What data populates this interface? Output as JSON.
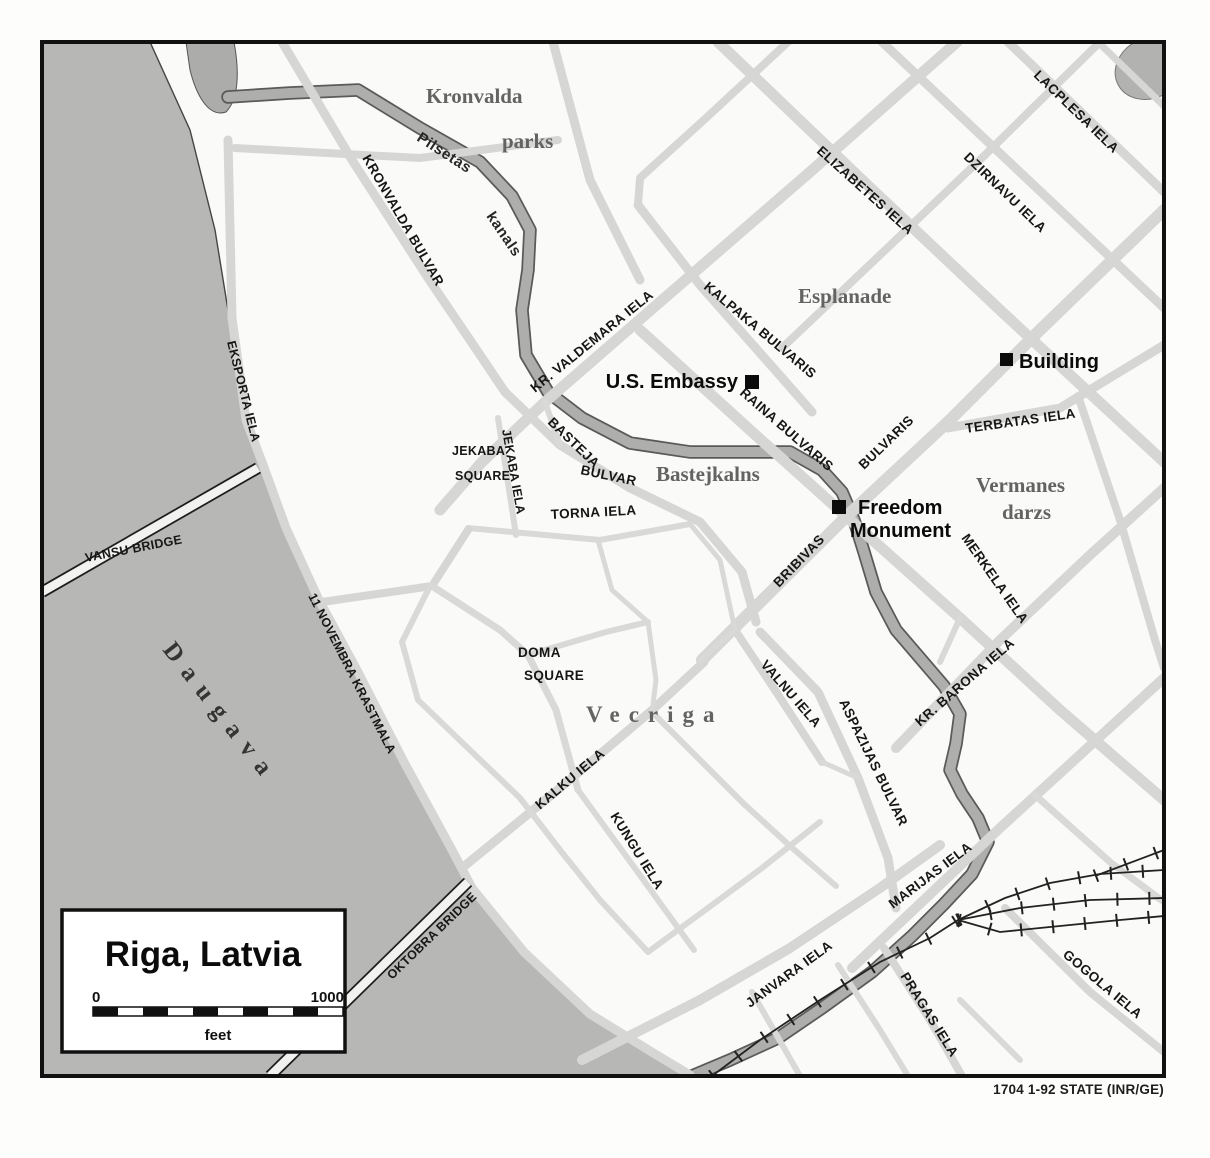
{
  "map": {
    "region_title": "Riga, Latvia",
    "credit": "1704 1-92 STATE (INR/GE)",
    "scale_bar": {
      "start_label": "0",
      "end_label": "1000",
      "unit_label": "feet"
    },
    "water": {
      "river": "Daugava",
      "canal_line1": "Pilsetas",
      "canal_line2": "kanals"
    },
    "areas": {
      "kronvalda_line1": "Kronvalda",
      "kronvalda_line2": "parks",
      "esplanade": "Esplanade",
      "bastejkalns": "Bastejkalns",
      "vermanes_line1": "Vermanes",
      "vermanes_line2": "darzs",
      "vecriga": "Vecriga"
    },
    "squares": {
      "jekaba_line1": "JEKABA",
      "jekaba_line2": "SQUARE",
      "doma_line1": "DOMA",
      "doma_line2": "SQUARE"
    },
    "pois": {
      "us_embassy": "U.S. Embassy",
      "building": "Building",
      "freedom_line1": "Freedom",
      "freedom_line2": "Monument"
    },
    "bridges": {
      "vansu": "VANSU BRIDGE",
      "oktobra": "OKTOBRA BRIDGE"
    },
    "streets": {
      "kronvalda_bulvar": "KRONVALDA BULVAR",
      "eksporta_iela": "EKSPORTA IELA",
      "novembra_krastmala": "11 NOVEMBRA KRASTMALA",
      "kr_valdemara_iela": "KR. VALDEMARA IELA",
      "elizabetes_iela": "ELIZABETES IELA",
      "dzirnavu_iela": "DZIRNAVU IELA",
      "lacplesa_iela": "LACPLESA IELA",
      "kalpaka_bulvaris": "KALPAKA BULVARIS",
      "raina_bulvaris": "RAINA BULVARIS",
      "terbatas_iela": "TERBATAS IELA",
      "bulvaris": "BULVARIS",
      "bribivas": "BRIBIVAS",
      "merkela_iela": "MERKELA IELA",
      "kr_barona_iela": "KR. BARONA IELA",
      "valnu_iela": "VALNU IELA",
      "aspazijas_bulvar": "ASPAZIJAS BULVAR",
      "kalku_iela": "KALKU IELA",
      "kungu_iela": "KUNGU IELA",
      "torna_iela": "TORNA IELA",
      "jekaba_iela": "JEKABA IELA",
      "basteja_line1": "BASTEJA",
      "basteja_line2": "BULVAR",
      "janvara_iela": "JANVARA IELA",
      "marijas_iela": "MARIJAS IELA",
      "pragas_iela": "PRAGAS IELA",
      "gogola_iela": "GOGOLA IELA"
    },
    "colors": {
      "paper": "#fdfdfb",
      "map_bg": "#fafaf8",
      "river": "#b7b7b5",
      "canal": "#aeaeac",
      "canal_edge": "#5a5a58",
      "road": "#d6d6d4",
      "frame": "#111111",
      "rail": "#222222"
    }
  }
}
